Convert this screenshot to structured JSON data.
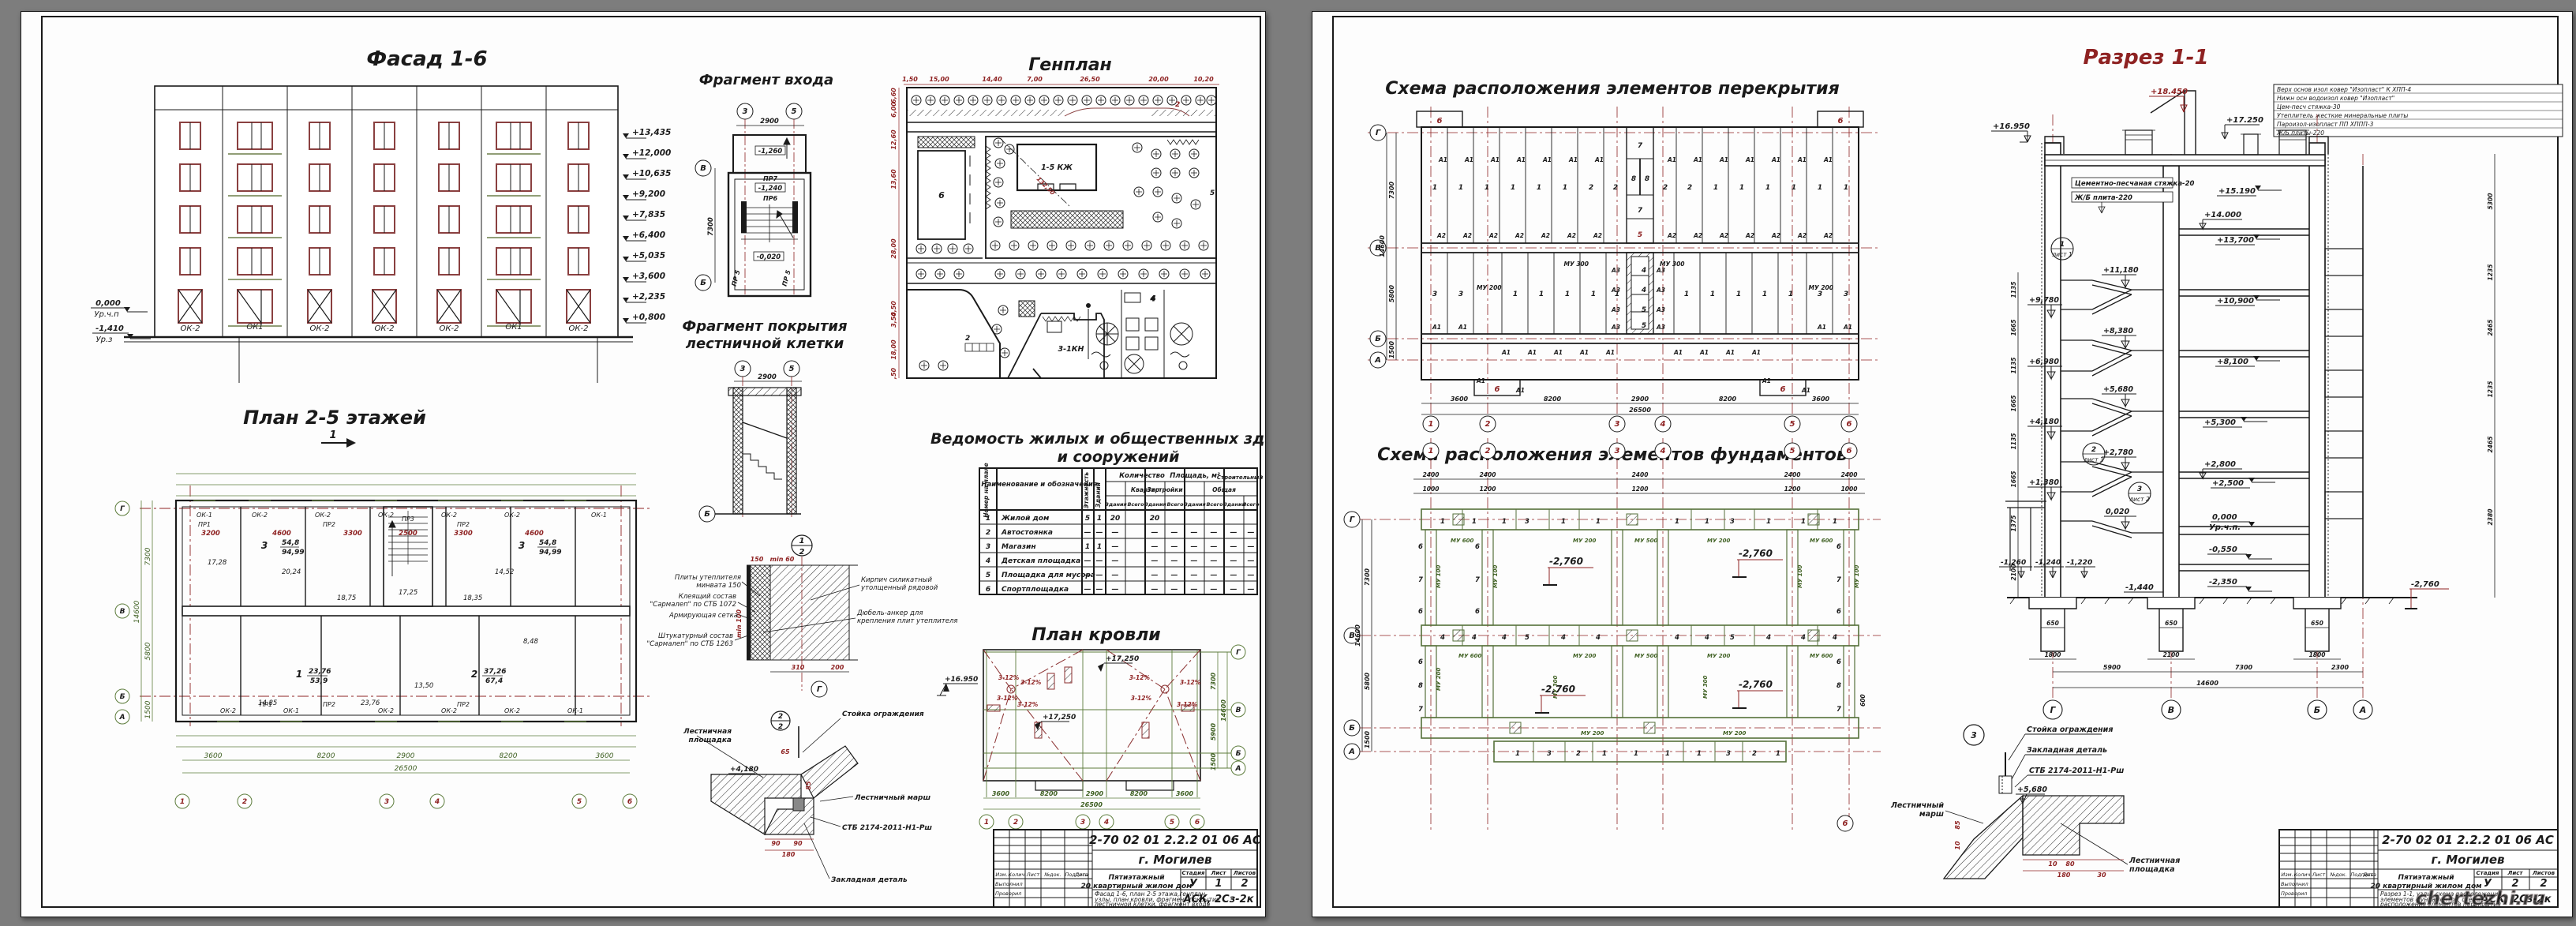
{
  "left": {
    "facade": {
      "title": "Фасад 1-6",
      "windows": [
        "ОК-2",
        "ОК1",
        "ОК-2",
        "ОК-2",
        "ОК-2",
        "ОК1",
        "ОК-2"
      ],
      "marks_right": [
        "+13,435",
        "+12,000",
        "+10,635",
        "+9,200",
        "+7,835",
        "+6,400",
        "+5,035",
        "+3,600",
        "+2,235",
        "+0,800"
      ],
      "zero": "0,000",
      "zero_lbl": "Ур.ч.п",
      "minus": "-1,410",
      "minus_lbl": "Ур.з"
    },
    "entry": {
      "title": "Фрагмент входа",
      "ax3": "3",
      "ax5": "5",
      "d2900": "2900",
      "axV": "В",
      "axB": "Б",
      "d7300": "7300",
      "m1": "-1,260",
      "pr7": "ПР7",
      "m2": "-1,240",
      "pr6": "ПР6",
      "m3": "-0,020",
      "pr5": "ПР 5"
    },
    "stairroof": {
      "t1": "Фрагмент покрытия",
      "t2": "лестничной клетки",
      "ax3": "3",
      "ax5": "5",
      "d2900": "2900",
      "axB": "Б"
    },
    "genplan": {
      "title": "Генплан",
      "top_dims": [
        "1,50",
        "15,00",
        "14,40",
        "7,00",
        "26,50",
        "20,00",
        "10,20"
      ],
      "left_dims": [
        "6,60",
        "6,00",
        "12,60",
        "13,60",
        "28,00",
        "4,50",
        "3,50",
        "18,00",
        ",50"
      ],
      "b6": "6",
      "b15": "1-5 КЖ",
      "b3": "3-1КН",
      "b4": "4",
      "r2": "2",
      "r2b": "2",
      "r5": "5",
      "diag": "132,50"
    },
    "plan": {
      "title": "План 2-5 этажей",
      "sec": "1",
      "ap3": "3",
      "ap3a": "54,8",
      "ap3b": "94,99",
      "ap1": "1",
      "ap1a": "23,76",
      "ap1b": "53,9",
      "ap2": "2",
      "ap2a": "37,26",
      "ap2b": "67,4",
      "areas": [
        "20,24",
        "14,52",
        "17,28",
        "18,75",
        "17,25",
        "18,35",
        "8,48",
        "14,85",
        "23,76",
        "13,50"
      ],
      "ok_top": [
        "ОК-1",
        "ОК-2",
        "ОК-2",
        "ОК-2",
        "ОК-2",
        "ОК-2",
        "ОК-1"
      ],
      "ok_bot": [
        "ОК-2",
        "ОК-1",
        "ОК-2",
        "ОК-2",
        "ОК-2",
        "ОК-1"
      ],
      "pr": [
        "ПР1",
        "ПР2",
        "ПР2",
        "ПР3",
        "ПР2",
        "ПР2",
        "ПР1"
      ],
      "dims_red": [
        "3200",
        "4600",
        "3300",
        "2500",
        "3300",
        "4600"
      ],
      "dims_bot": [
        "3600",
        "8200",
        "2900",
        "8200",
        "3600"
      ],
      "total": "26500",
      "left_dims": [
        "7300",
        "5800",
        "1500"
      ],
      "left_total": "14600",
      "axes_bot": [
        "1",
        "2",
        "3",
        "4",
        "5",
        "6"
      ],
      "axes_left": [
        "Г",
        "В",
        "Б",
        "А"
      ]
    },
    "table": {
      "t1": "Ведомость жилых и общественных зданий",
      "t2": "и сооружений",
      "h_num": "Номер на плане",
      "h_name": "Наименование и обозначение",
      "h_fl": "Этажность",
      "h_qty": "Количество",
      "h_bld": "Зданий",
      "h_apt": "Квартир",
      "h_area": "Площадь, м²",
      "h_zas": "Застройки",
      "h_obsh": "Общая",
      "h_vol": "Строительный объем",
      "h_zd": "Здания",
      "h_vs": "Всего",
      "rows": [
        [
          "1",
          "Жилой дом",
          "5",
          "1",
          "20",
          "20",
          "",
          "",
          "",
          "",
          ""
        ],
        [
          "2",
          "Автостоянка",
          "—",
          "—",
          "—",
          "—",
          "—",
          "—",
          "—",
          "—",
          "—"
        ],
        [
          "3",
          "Магазин",
          "1",
          "1",
          "—",
          "—",
          "—",
          "—",
          "—",
          "—",
          "—"
        ],
        [
          "4",
          "Детская площадка",
          "—",
          "—",
          "—",
          "—",
          "—",
          "—",
          "—",
          "—",
          "—"
        ],
        [
          "5",
          "Площадка для мусора",
          "—",
          "—",
          "—",
          "—",
          "—",
          "—",
          "—",
          "—",
          "—"
        ],
        [
          "6",
          "Спортплощадка",
          "—",
          "—",
          "—",
          "—",
          "—",
          "—",
          "—",
          "—",
          "—"
        ]
      ]
    },
    "node12": {
      "n1": "1",
      "n2": "2",
      "axG": "Г",
      "d150": "150",
      "dmin60": "min 60",
      "dmin100": "min 100",
      "d310": "310",
      "d200": "200",
      "l1": "Плиты утеплителя",
      "l1b": "минвата 150",
      "l2": "Клеящий состав",
      "l2b": "\"Сармалеп\" по СТБ 1072",
      "l3": "Армирующая сетка",
      "l4": "Штукатурный состав",
      "l4b": "\"Сармалеп\" по СТБ 1263",
      "r1": "Кирпич силикатный",
      "r1b": "утолщенный рядовой",
      "r2": "Дюбель-анкер для",
      "r2b": "крепления плит утеплителя"
    },
    "roof": {
      "title": "План кровли",
      "elev": "+16.950",
      "e1": "+17,250",
      "e2": "+17,250",
      "slope": "3-12%",
      "dims_bot": [
        "3600",
        "8200",
        "2900",
        "8200",
        "3600"
      ],
      "total": "26500",
      "right_dims": [
        "7300",
        "5900",
        "1500"
      ],
      "right_total": "14600",
      "axes_bot": [
        "1",
        "2",
        "3",
        "4",
        "5",
        "6"
      ],
      "axes_right": [
        "Г",
        "В",
        "Б",
        "А"
      ]
    },
    "node22": {
      "n1": "2",
      "n2": "2",
      "l1": "Лестничная",
      "l1b": "площадка",
      "l2": "Стойка ограждения",
      "l3": "Лестничный марш",
      "l4": "СТБ 2174-2011-Н1-Рш",
      "l5": "Закладная деталь",
      "e": "+4,180",
      "d65": "65",
      "d85": "85",
      "d90": "90",
      "d90b": "90",
      "d180": "180"
    },
    "tb": {
      "doc": "2-70 02 01 2.2.2 01 06 АС",
      "city": "г. Могилев",
      "obj1": "Пятиэтажный",
      "obj2": "20 квартирный жилом дом",
      "cnt1": "Фасад 1-6, план 2-5 этажа,генплан,",
      "cnt2": "узлы, план кровли, фрагмент покрытия",
      "cnt3": "лестничной клетки, фрагмент входа",
      "stage_h": "Стадия",
      "sheet_h": "Лист",
      "sheets_h": "Листов",
      "stage": "У",
      "sheet": "1",
      "sheets": "2",
      "org": "АСК, 2Сз-2к",
      "c1": "Изм.",
      "c2": "Колич.",
      "c3": "Лист",
      "c4": "№док.",
      "c5": "Подпись",
      "c6": "Дата",
      "made": "Выполнил",
      "check": "Проверил"
    }
  },
  "right": {
    "slab": {
      "title": "Схема расположения элементов перекрытия",
      "top_left": [
        "1",
        "1",
        "1",
        "1",
        "1",
        "1",
        "2",
        "2"
      ],
      "mid": [
        "7",
        "8",
        "8",
        "7",
        "5"
      ],
      "top_right": [
        "2",
        "2",
        "1",
        "1",
        "1",
        "1",
        "1",
        "1"
      ],
      "bot_left": [
        "3",
        "3"
      ],
      "bot_l1": [
        "1",
        "1",
        "1",
        "1",
        "1"
      ],
      "bot_c": [
        "4",
        "4",
        "5",
        "5"
      ],
      "bot_r1": [
        "1",
        "1",
        "1",
        "1",
        "1"
      ],
      "bot_right": [
        "3",
        "3"
      ],
      "a1": "А1",
      "a2": "А2",
      "a3": "А3",
      "mu300": "МУ 300",
      "mu200": "МУ 200",
      "c6": "6",
      "dims_bot": [
        "3600",
        "8200",
        "2900",
        "8200",
        "3600"
      ],
      "total": "26500",
      "left_dims": [
        "7300",
        "5800",
        "1500"
      ],
      "left_total": "14600",
      "axes_left": [
        "Г",
        "В",
        "Б",
        "А"
      ],
      "axes_bot": [
        "1",
        "2",
        "3",
        "4",
        "5",
        "6"
      ]
    },
    "found": {
      "title": "Схема расположения элементов фундаментов",
      "top_dims": [
        "2400",
        "2400",
        "2400",
        "2400",
        "2400"
      ],
      "sub_dims": [
        "1000",
        "1200",
        "1200",
        "1200",
        "1000"
      ],
      "elev": "-2,760",
      "mu600": "МУ 600",
      "mu200": "МУ 200",
      "mu500": "МУ 500",
      "mu100": "МУ 100",
      "mu300": "МУ 300",
      "row_g": [
        "1",
        "1",
        "1",
        "3",
        "1",
        "1",
        "1",
        "1",
        "3",
        "1",
        "1",
        "1"
      ],
      "row_v": [
        "4",
        "4",
        "4",
        "5",
        "4",
        "4",
        "4",
        "4",
        "5",
        "4",
        "4",
        "4"
      ],
      "row_a": [
        "1",
        "3",
        "2",
        "1",
        "1",
        "1",
        "1",
        "3",
        "2",
        "1"
      ],
      "col_up": [
        "6",
        "7",
        "6"
      ],
      "col_dn": [
        "6",
        "8",
        "7"
      ],
      "d600": "600",
      "left_dims": [
        "7300",
        "5800",
        "1500"
      ],
      "left_total": "14600",
      "axes_left": [
        "Г",
        "В",
        "Б",
        "А"
      ],
      "axes_top": [
        "1",
        "2",
        "3",
        "4",
        "5",
        "6"
      ]
    },
    "section": {
      "title": "Разрез 1-1",
      "e_top": "+18.450",
      "e_par": "+16.950",
      "e_r": "+17.250",
      "right_marks": [
        "+15.190",
        "+14.000",
        "+13,700",
        "+10,900",
        "+8,100",
        "+5,300",
        "+2,800",
        "+2,500"
      ],
      "e0": "0,000",
      "e0l": "Ур.ч.п.",
      "em055": "-0,550",
      "em235": "-2,350",
      "em276": "-2,760",
      "em144": "-1,440",
      "em126": "-1,260",
      "em124": "-1,240",
      "em122": "-1,220",
      "st": [
        "+11,180",
        "+9,780",
        "+8,380",
        "+6,980",
        "+5,680",
        "+4,180",
        "+2,780",
        "+1,380",
        "0,020"
      ],
      "lbl1": "Цементно-песчаная стяжка-20",
      "lbl2": "Ж/Б плита-220",
      "n1": "1",
      "n1l": "лист 1",
      "n2": "2",
      "n2l": "лист 1",
      "n3": "3",
      "n3l": "лист 2",
      "roofnote": [
        "Верх основ изол ковер \"Изопласт\" К ХПП-4",
        "Нижн осн водоизол ковер \"Изопласт\"",
        "Цем-песч стяжка-30",
        "Утеплитель жесткие минеральные плиты",
        "Пароизол-изопласт ПП ХППП-3",
        "Ж/Б  плиты-220"
      ],
      "d650": "650",
      "d1800": "1800",
      "d2100": "2100",
      "d1800b": "1800",
      "dims_bot": [
        "5900",
        "7300",
        "2300"
      ],
      "total": "14600",
      "left_chain": [
        "1135",
        "1665",
        "1135",
        "1665",
        "1135",
        "1665",
        "1375",
        "2100"
      ],
      "right_chain": [
        "5300",
        "1235",
        "2465",
        "1235",
        "2465",
        "2380"
      ],
      "axes": [
        "Г",
        "В",
        "Б",
        "А"
      ]
    },
    "node3": {
      "n": "3",
      "l1": "Стойка ограждения",
      "l2": "Закладная деталь",
      "l3": "СТБ 2174-2011-Н1-Рш",
      "l4": "Лестничный",
      "l4b": "марш",
      "l5": "Лестничная",
      "l5b": "площадка",
      "e": "+5,680",
      "d85": "85",
      "d10": "10",
      "d10b": "10",
      "d80": "80",
      "d180": "180",
      "d30": "30"
    },
    "tb": {
      "doc": "2-70 02 01 2.2.2 01 06 АС",
      "city": "г. Могилев",
      "obj1": "Пятиэтажный",
      "obj2": "20 квартирный жилом дом",
      "cnt1": "Разрез 1-1, узлы, схема расположения",
      "cnt2": "элементов фундаментов, схема",
      "cnt3": "расположения элементов перекрытия",
      "stage_h": "Стадия",
      "sheet_h": "Лист",
      "sheets_h": "Листов",
      "stage": "У",
      "sheet": "2",
      "sheets": "2",
      "org": "АСК, 2Сз-2к",
      "c1": "Изм.",
      "c2": "Колич.",
      "c3": "Лист",
      "c4": "№док.",
      "c5": "Подпись",
      "c6": "Дата",
      "made": "Выполнил",
      "check": "Проверил"
    },
    "watermark": "chertezhi.ru"
  }
}
